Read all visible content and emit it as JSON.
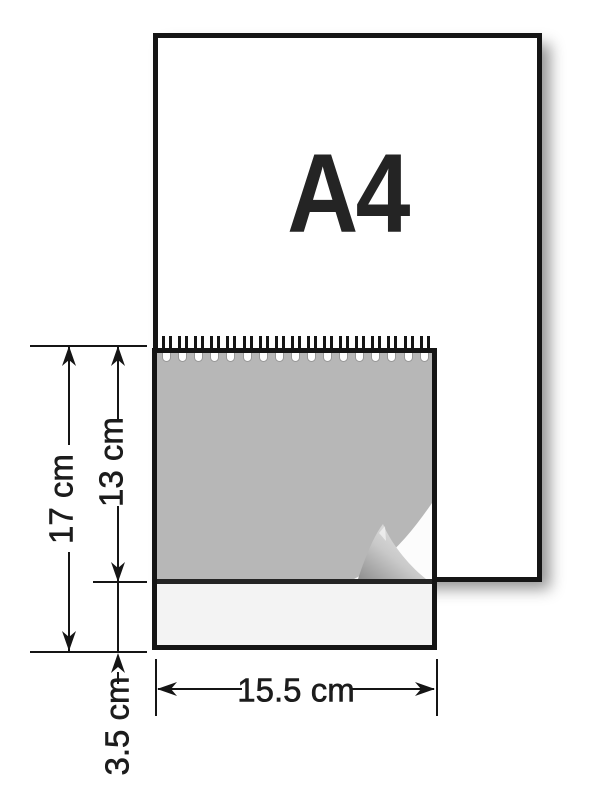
{
  "diagram": {
    "title_label": "A4",
    "dimensions": {
      "total_height": {
        "label": "17 cm",
        "value_cm": 17,
        "orientation": "vertical"
      },
      "overlap_height": {
        "label": "13 cm",
        "value_cm": 13,
        "orientation": "vertical"
      },
      "flap_height": {
        "label": "3.5 cm",
        "value_cm": 3.5,
        "orientation": "vertical"
      },
      "width": {
        "label": "15.5 cm",
        "value_cm": 15.5,
        "orientation": "horizontal"
      }
    },
    "notepad": {
      "spiral_ring_count": 17
    },
    "colors": {
      "outline": "#151515",
      "notepad_gray": "#b7b7b7",
      "flap_light": "#f3f3f3",
      "paper_white": "#ffffff"
    }
  }
}
